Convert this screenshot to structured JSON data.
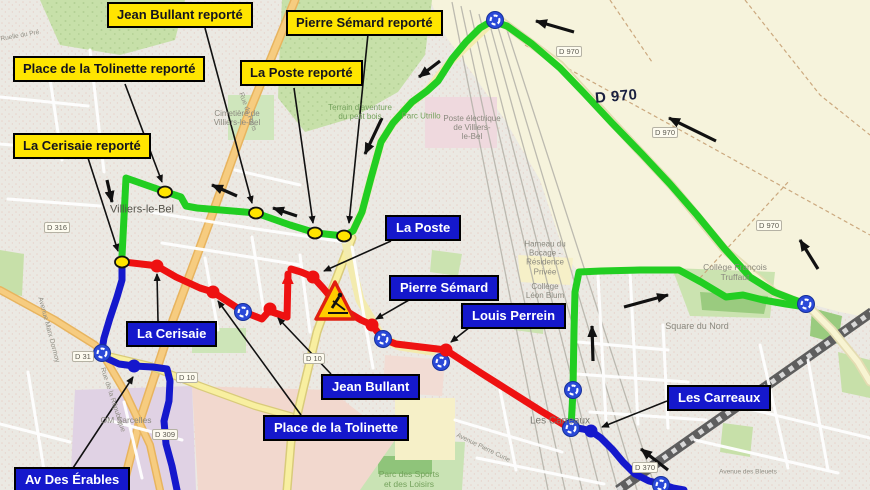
{
  "title": "Plan de déviation bus - Villiers-le-Bel",
  "relocated_stops": {
    "jean_bullant": "Jean Bullant reporté",
    "pierre_semard": "Pierre Sémard reporté",
    "place_tolinette": "Place de la Tolinette reporté",
    "la_poste": "La Poste reporté",
    "la_cerisaie": "La Cerisaie reporté"
  },
  "stops": {
    "la_poste": "La Poste",
    "pierre_semard": "Pierre Sémard",
    "louis_perrein": "Louis Perrein",
    "la_cerisaie": "La Cerisaie",
    "jean_bullant": "Jean Bullant",
    "place_tolinette": "Place de la Tolinette",
    "les_carreaux": "Les Carreaux",
    "av_des_erables": "Av Des Érables"
  },
  "map": {
    "town_label": "Villiers-le-Bel",
    "d970_label": "D 970",
    "places": {
      "cimetiere": "Cimetière de\nVilliers-le-Bel",
      "terrain": "Terrain d'aventure\ndu petit bois",
      "parc_utrillo": "Parc Utrillo",
      "poste_electrique": "Poste électrique\nde Villiers-\nle-Bel",
      "hameau": "Hameau du\nBocage -\nRésidence\nPrivée",
      "college_leon_blum": "Collège\nLéon Blum",
      "college_truffaut": "Collège François\nTruffaut",
      "square_du_nord": "Square du Nord",
      "les_carreaux_place": "Les Carreaux",
      "parc_des_sports": "Parc des Sports\net des Loisirs",
      "om_sarcelles": "OM Sarcelles",
      "rue_de_paris": "Rue de Paris",
      "rue_republique": "Rue de la République",
      "avenue_marx_dormoy": "Avenue Marx Dormoy",
      "ruelle_du_pre": "Ruelle du Pré",
      "avenue_des_bleuets": "Avenue des Bleuets",
      "avenue_pierre_curie": "Avenue Pierre Curie"
    },
    "shields": {
      "d316": "D 316",
      "d31": "D 31",
      "d10": "D 10",
      "d309": "D 309",
      "d970": "D 970",
      "d370": "D 370"
    }
  },
  "icons": {
    "roundabout": "roundabout-icon",
    "roadworks": "roadworks-warning-icon",
    "relocated_stop_dot": "relocated-stop-dot",
    "closed_stop_dot": "closed-stop-dot",
    "route_stop_dot": "route-stop-dot"
  },
  "colors": {
    "deviation_green": "#22CE22",
    "closed_red": "#EE1111",
    "route_blue": "#1518CC",
    "relocated_yellow": "#FFE500",
    "label_blue_bg": "#1518CC",
    "label_yellow_bg": "#FFE500"
  }
}
